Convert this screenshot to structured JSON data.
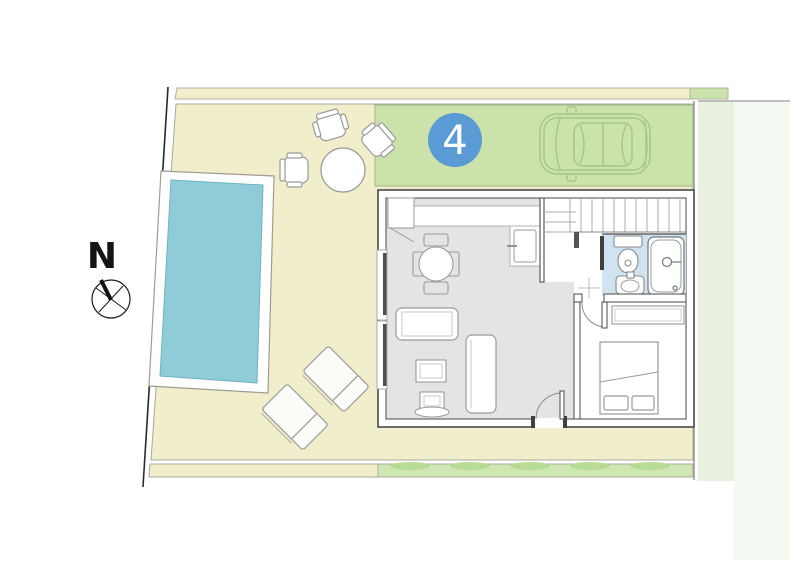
{
  "compass": {
    "label": "N"
  },
  "badge": {
    "number": "4"
  },
  "colors": {
    "plot_beige": "#f1eecb",
    "parking_green": "#cbe3ab",
    "strip_green": "#cfe7b2",
    "neighbor_green": "#e9f2e0",
    "pool_blue": "#8fccd8",
    "bathroom_blue": "#cfe3f1",
    "badge_blue": "#5b9bd5",
    "floor_gray": "#e4e4e4"
  },
  "objects": {
    "pool": "swimming-pool",
    "car": "car-top-view",
    "outdoor_dining": "round-table-with-3-chairs",
    "sun_loungers": 2,
    "rooms": [
      "living-kitchen",
      "stair-hall",
      "bathroom",
      "bedroom"
    ],
    "fixtures": [
      "stairs",
      "kitchen-sink",
      "toilet",
      "washbasin",
      "bathtub"
    ],
    "furniture": [
      "dining-table-4-chairs",
      "sofa",
      "coffee-table",
      "daybed",
      "tv-unit",
      "double-bed",
      "wardrobe"
    ]
  }
}
